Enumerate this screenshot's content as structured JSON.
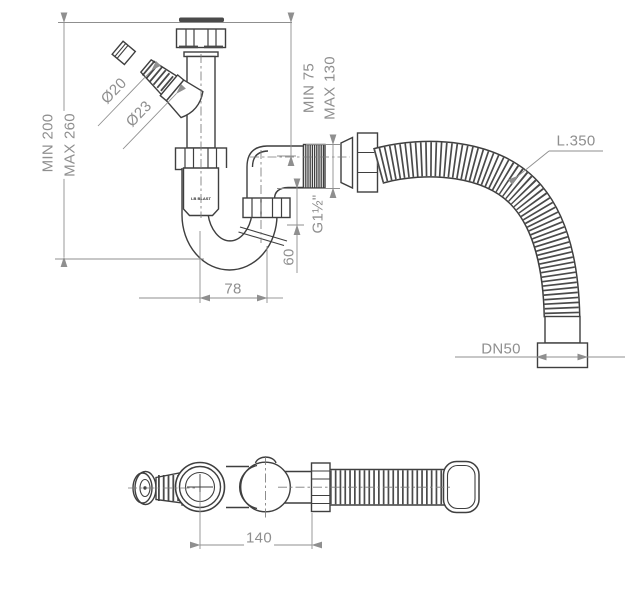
{
  "title": "Sink trap with flexible hose - technical drawing",
  "colors": {
    "outline": "#3f3f3f",
    "dimension": "#8f8f8f",
    "background": "#ffffff"
  },
  "front_view": {
    "dimensions": {
      "height_min": "MIN 200",
      "height_max": "MAX 260",
      "inlet_min": "MIN 75",
      "inlet_max": "MAX 130",
      "branch_inner_diameter": "Ø20",
      "branch_outer_diameter": "Ø23",
      "outlet_thread": "G1½\"",
      "outlet_drop": "60",
      "trap_width": "78",
      "hose_length": "L.350",
      "hose_outlet": "DN50"
    },
    "brand_mark": "LB BLAST"
  },
  "bottom_view": {
    "dimensions": {
      "trap_length": "140"
    }
  }
}
